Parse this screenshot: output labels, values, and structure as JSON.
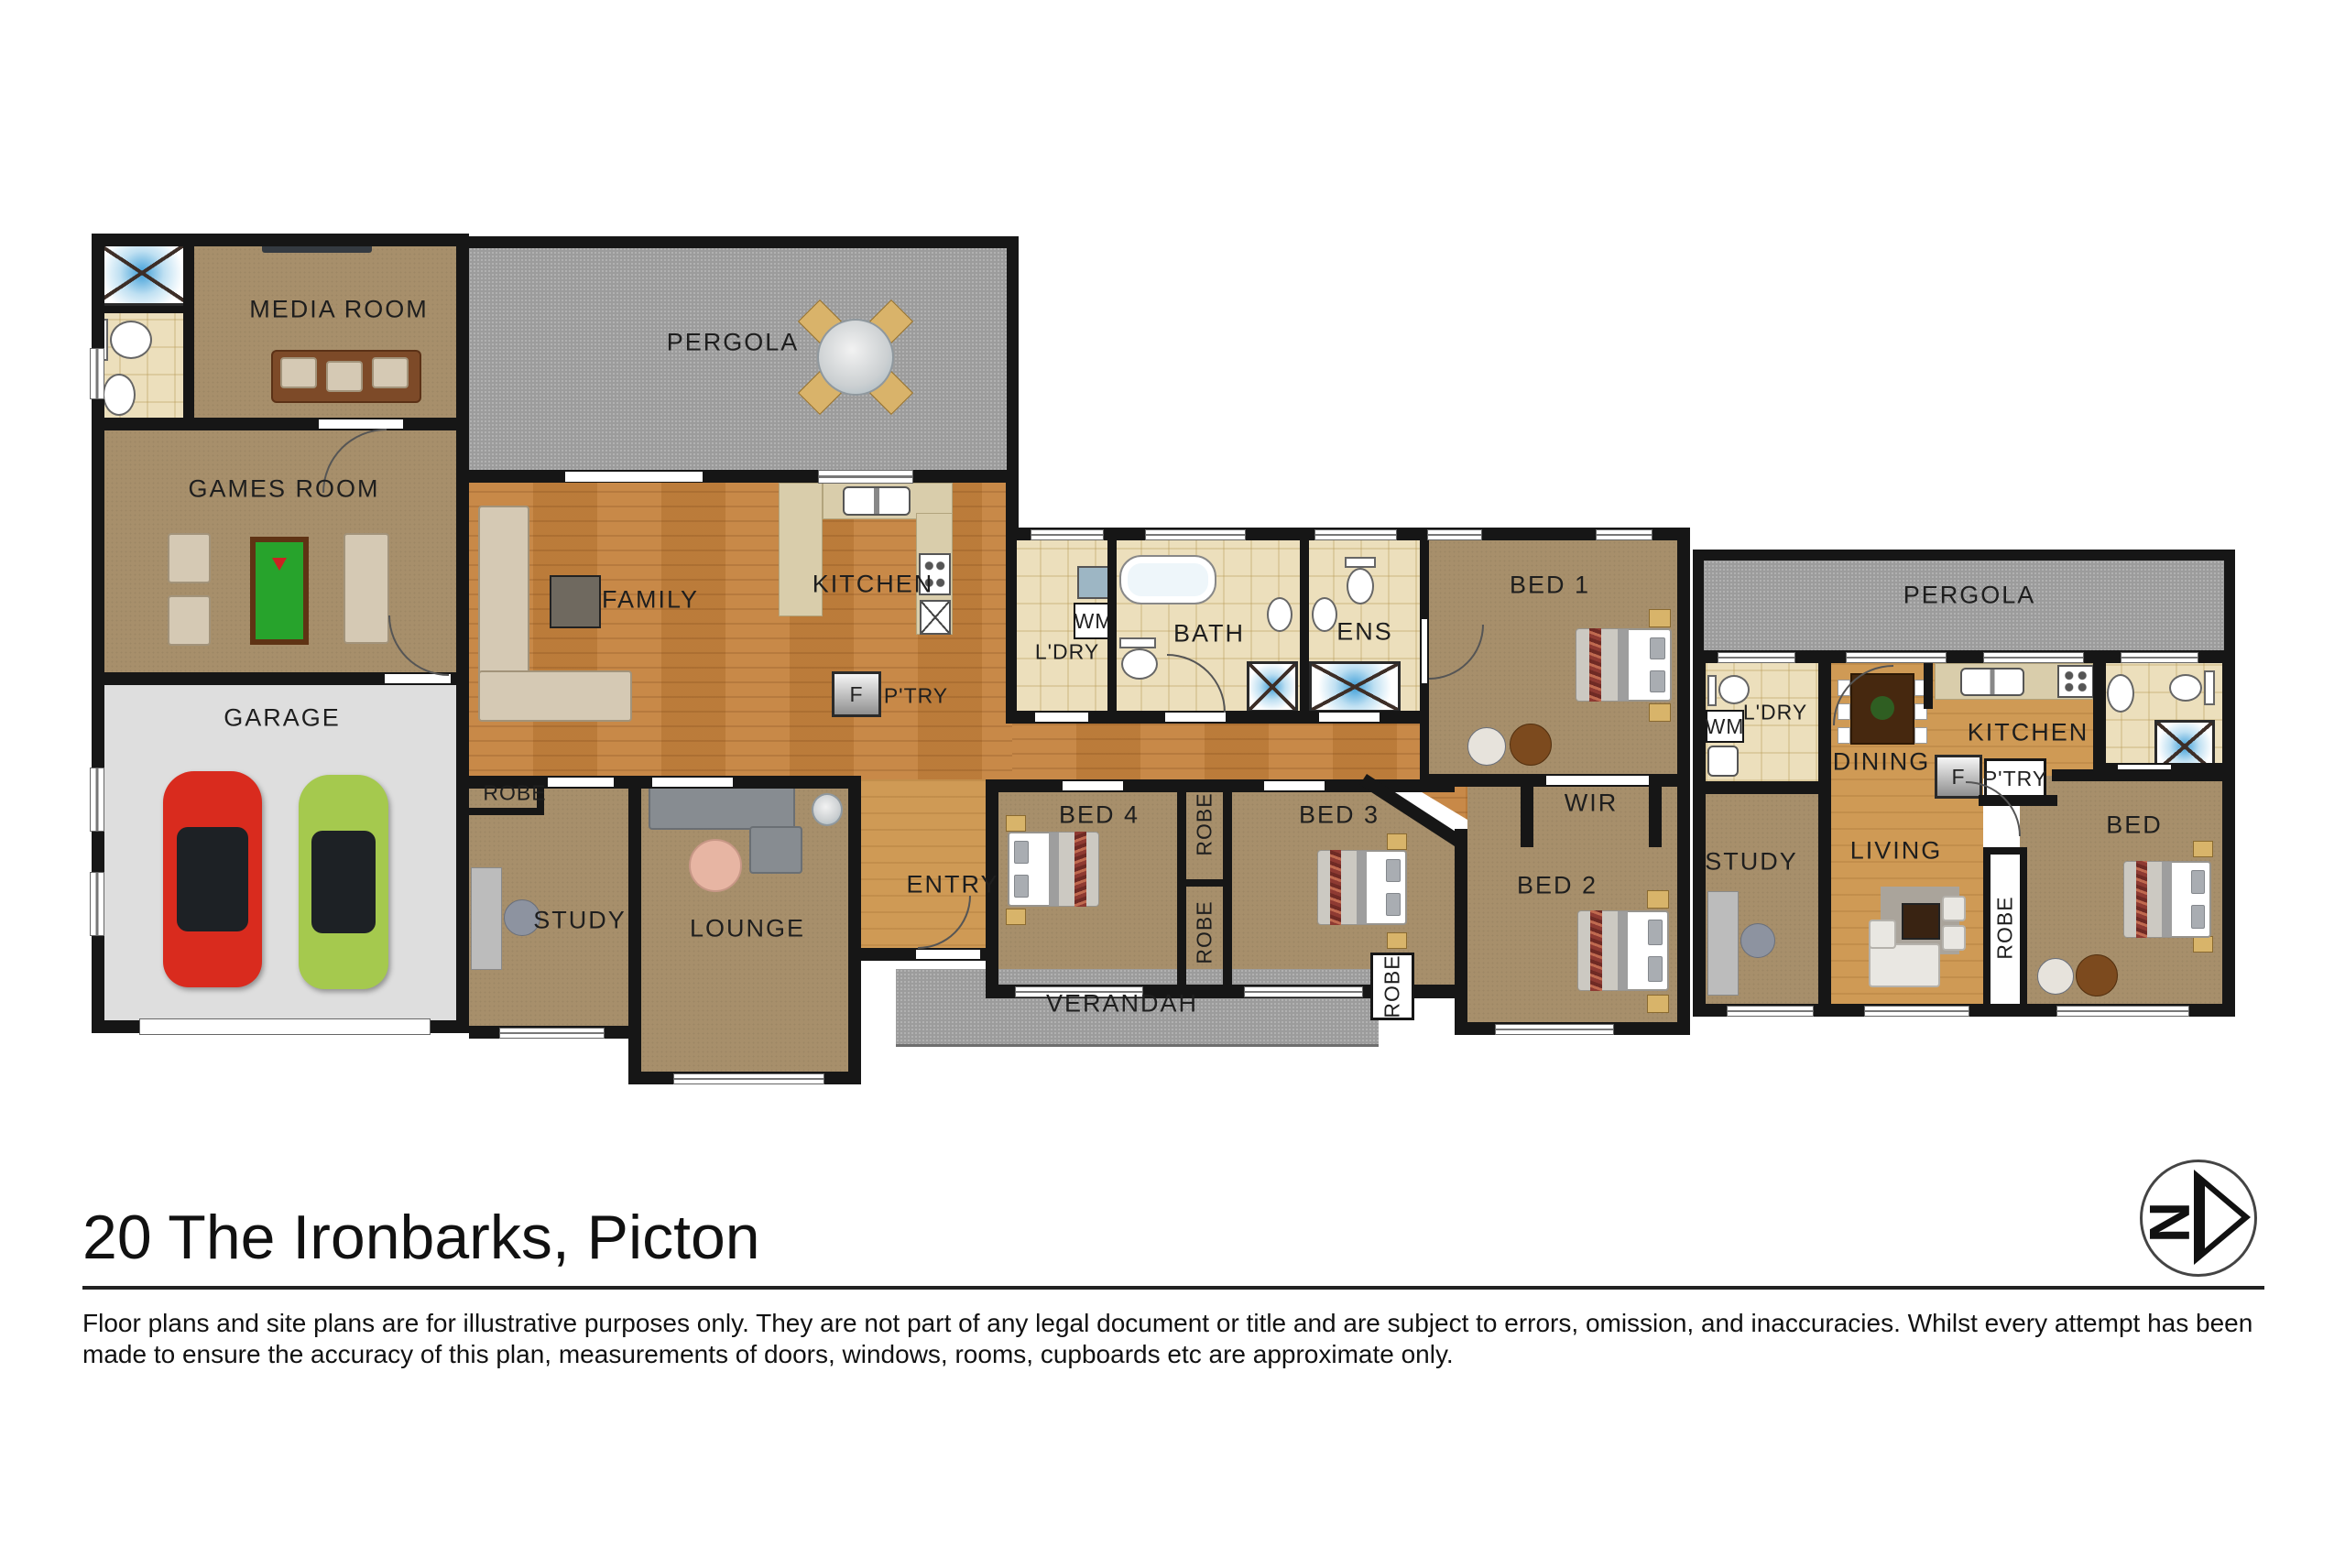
{
  "meta": {
    "address": "20 The Ironbarks, Picton"
  },
  "floorplan": {
    "rooms": {
      "media_room": "MEDIA ROOM",
      "games_room": "GAMES ROOM",
      "garage": "GARAGE",
      "pergola_top": "PERGOLA",
      "family": "FAMILY",
      "kitchen": "KITCHEN",
      "laundry": "L'DRY",
      "washing_machine": "WM",
      "bath": "BATH",
      "ens": "ENS",
      "bed1": "BED 1",
      "pergola_right": "PERGOLA",
      "wir": "WIR",
      "fridge": "F",
      "pantry": "P'TRY",
      "robe_study": "ROBE",
      "study": "STUDY",
      "lounge": "LOUNGE",
      "entry": "ENTRY",
      "bed4": "BED 4",
      "robe_bed4": "ROBE",
      "robe_bed3": "ROBE",
      "bed3": "BED 3",
      "robe_hall": "ROBE",
      "bed2": "BED 2",
      "verandah": "VERANDAH",
      "flat_laundry": "L'DRY",
      "flat_wm": "WM",
      "flat_dining": "DINING",
      "flat_kitchen": "KITCHEN",
      "flat_fridge": "F",
      "flat_pantry": "P'TRY",
      "flat_study": "STUDY",
      "flat_living": "LIVING",
      "flat_robe": "ROBE",
      "flat_bed": "BED"
    }
  },
  "compass": {
    "letter": "N"
  },
  "footer": {
    "title": "20 The Ironbarks, Picton",
    "disclaimer": "Floor plans and site plans are for illustrative purposes only. They are not part of any legal document or title and are subject to errors, omission, and inaccuracies. Whilst every attempt has been made to ensure the accuracy of this plan, measurements of doors, windows, rooms, cupboards etc are approximate only."
  },
  "colors": {
    "wall": "#161616",
    "carpet": "#a78f6b",
    "wood": "#c5823d",
    "wood_light": "#cf9a55",
    "tile": "#ecdfbc",
    "pergola": "#9c9c9c",
    "garage_floor": "#dedede",
    "pool_table": "#27a32c",
    "car_red": "#d92b1e",
    "car_green": "#a5c94e"
  }
}
